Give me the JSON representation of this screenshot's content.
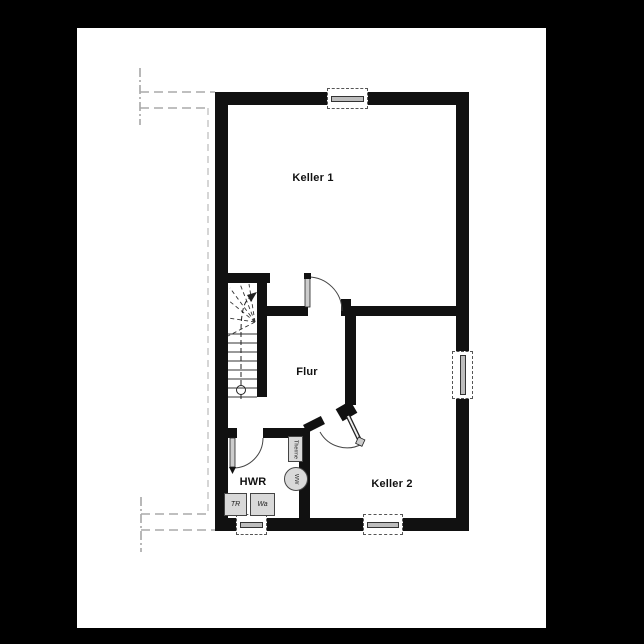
{
  "rooms": {
    "keller1": "Keller 1",
    "flur": "Flur",
    "hwr": "HWR",
    "keller2": "Keller 2"
  },
  "fixtures": {
    "therme": "Therme",
    "boiler": "WW",
    "dryer": "TR",
    "washer": "Wa"
  },
  "colors": {
    "wall": "#111111",
    "sheet": "#ffffff",
    "background": "#000000",
    "fixture_fill": "#d9d9d9",
    "window_glass": "#bdbdbd",
    "reference_line": "#aaaaaa"
  }
}
